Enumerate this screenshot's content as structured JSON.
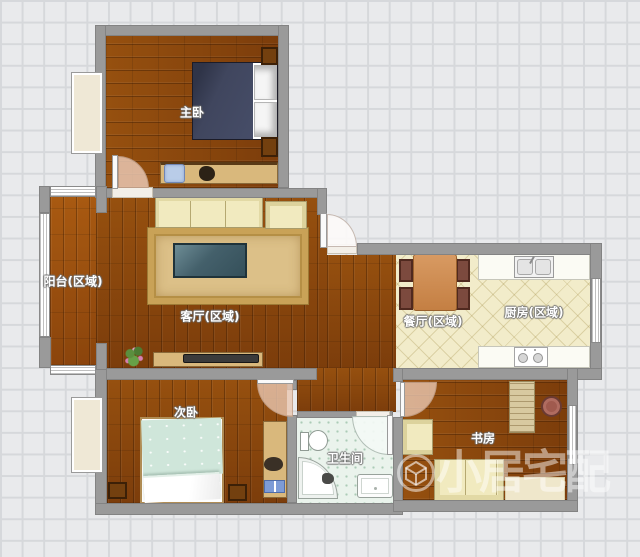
{
  "app": {
    "type": "floor-plan-editor-canvas"
  },
  "rooms": {
    "master_bedroom": {
      "label": "主卧"
    },
    "balcony": {
      "label": "阳台(区域)"
    },
    "living_room": {
      "label": "客厅(区域)"
    },
    "dining": {
      "label": "餐厅(区域)"
    },
    "kitchen": {
      "label": "厨房(区域)"
    },
    "second_bedroom": {
      "label": "次卧"
    },
    "bathroom": {
      "label": "卫生间"
    },
    "study": {
      "label": "书房"
    }
  },
  "watermark": {
    "brand_text": "小居宅配"
  },
  "colors": {
    "canvas_grid": "#e9eaec",
    "wall": "#9a9a9a",
    "wood_floor": "#8a4711",
    "kitchen_tile": "#f2ecca",
    "bath_tile": "#eaf3ec",
    "cream_furniture": "#f1eabf",
    "rug": "#d9bc82",
    "coffee_table": "#44606b",
    "master_bed": "#40465e",
    "second_bed": "#cfe6da",
    "dining_table": "#cd8a50",
    "chair_brown": "#7c4a3e"
  }
}
